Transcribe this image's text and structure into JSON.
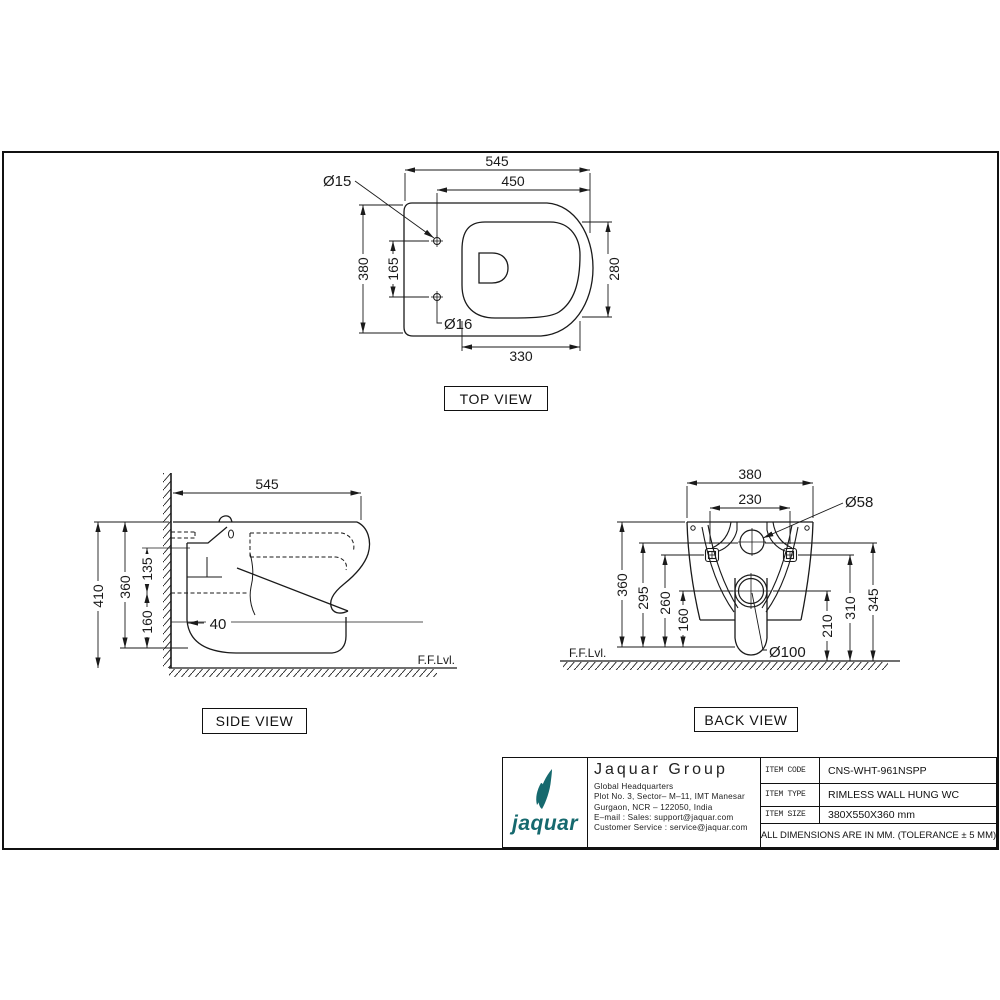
{
  "views": {
    "top": {
      "label": "TOP VIEW",
      "dims": {
        "overall_w": "545",
        "hinge_w": "450",
        "depth": "380",
        "hole_gap": "165",
        "seat_d": "280",
        "seat_w": "330",
        "hole_top": "Ø15",
        "hole_bottom": "Ø16"
      }
    },
    "side": {
      "label": "SIDE VIEW",
      "floor": "F.F.Lvl.",
      "dims": {
        "depth": "545",
        "h_total": "410",
        "h_body": "360",
        "h_upper": "135",
        "h_lower": "160",
        "setback": "40"
      }
    },
    "back": {
      "label": "BACK VIEW",
      "floor": "F.F.Lvl.",
      "dims": {
        "width": "380",
        "bolt_gap": "230",
        "inlet": "Ø58",
        "h360": "360",
        "h295": "295",
        "h260": "260",
        "h160": "160",
        "h210": "210",
        "h310": "310",
        "h345": "345",
        "outlet": "Ø100"
      }
    }
  },
  "title_block": {
    "brand": {
      "wordmark": "jaquar",
      "color": "#16696e"
    },
    "company": "Jaquar Group",
    "address": [
      "Global Headquarters",
      "Plot No. 3, Sector– M–11, IMT Manesar",
      "Gurgaon, NCR – 122050, India",
      "E–mail : Sales: support@jaquar.com",
      "Customer Service : service@jaquar.com"
    ],
    "fields": [
      {
        "label": "ITEM CODE",
        "value": "CNS-WHT-961NSPP"
      },
      {
        "label": "ITEM TYPE",
        "value": "RIMLESS WALL HUNG WC"
      },
      {
        "label": "ITEM SIZE",
        "value": "380X550X360 mm"
      }
    ],
    "note": "ALL DIMENSIONS ARE IN MM. (TOLERANCE ± 5 MM)"
  }
}
